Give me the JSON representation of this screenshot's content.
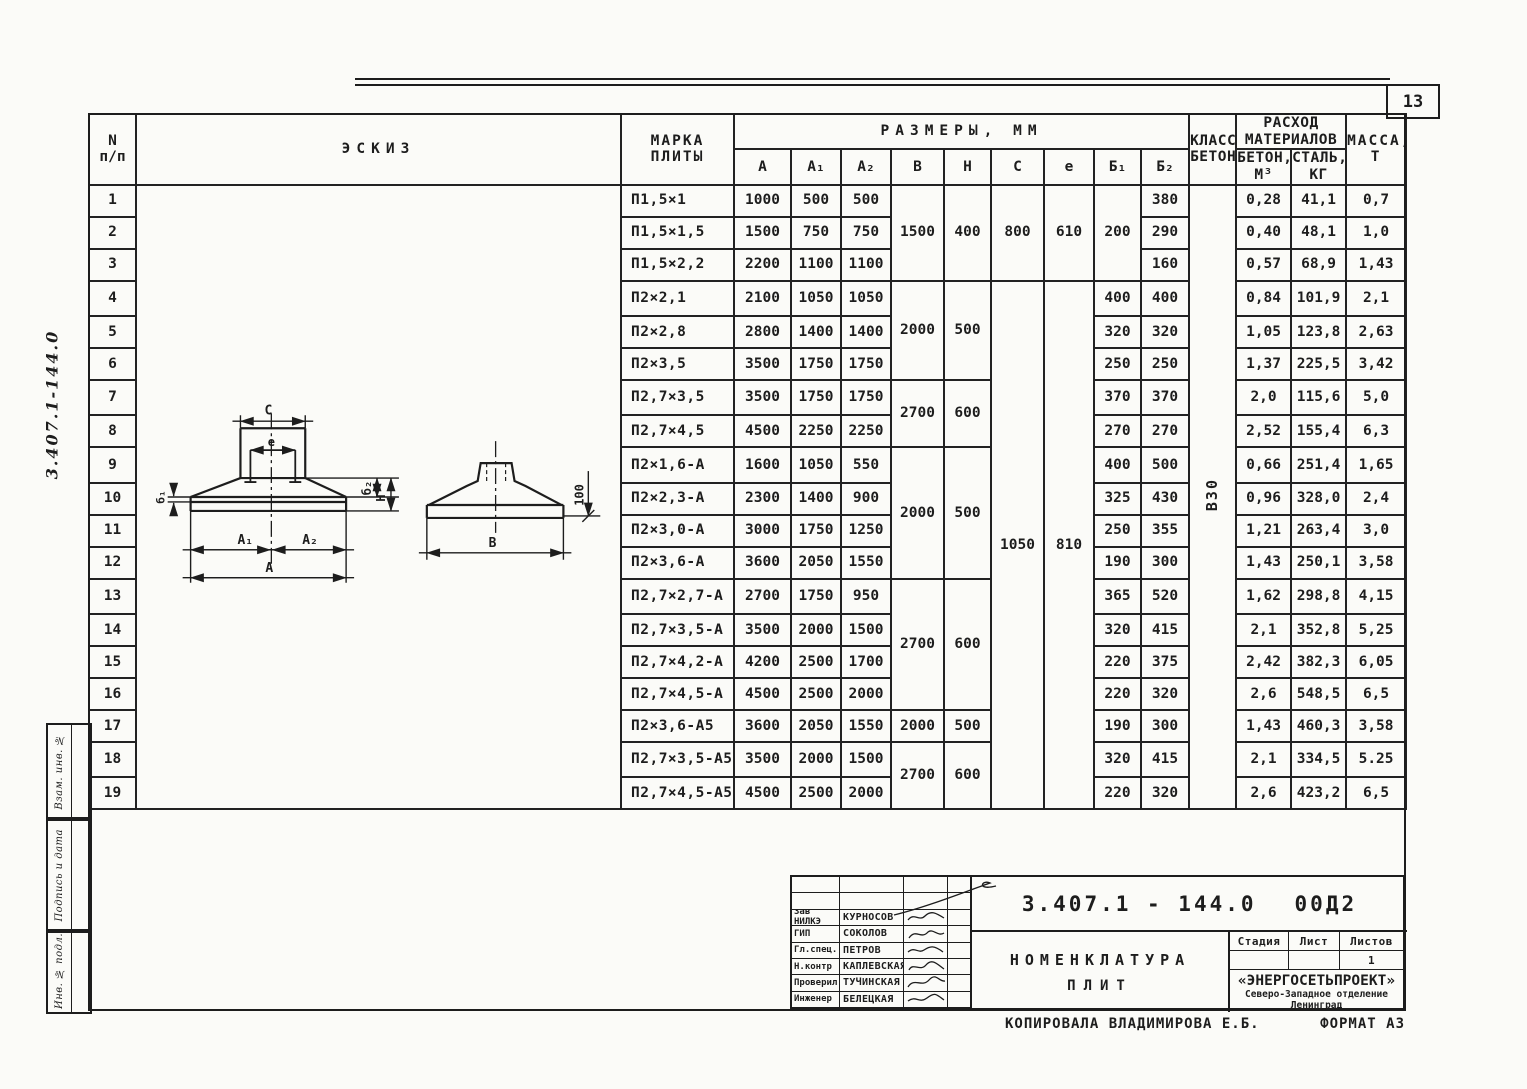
{
  "page": {
    "number": "13",
    "copied_by": "КОПИРОВАЛА ВЛАДИМИРОВА Е.Б.",
    "format": "ФОРМАТ А3"
  },
  "sidebar": {
    "doc_number_handwritten": "3.407.1-144.0",
    "boxes": [
      "Взам. инв. №",
      "Подпись и дата",
      "Инв. № подл."
    ]
  },
  "table": {
    "headers": {
      "n1": "N",
      "n2": "п/п",
      "sketch": "ЭСКИЗ",
      "mark1": "МАРКА",
      "mark2": "ПЛИТЫ",
      "dims": "РАЗМЕРЫ, ММ",
      "a": "А",
      "a1": "А₁",
      "a2": "А₂",
      "b": "В",
      "h": "Н",
      "c": "С",
      "e": "е",
      "b1": "Б₁",
      "b2": "Б₂",
      "class1": "КЛАСС",
      "class2": "БЕТОНА",
      "mat1": "РАСХОД",
      "mat2": "МАТЕРИАЛОВ",
      "concrete1": "БЕТОН,",
      "concrete2": "М³",
      "steel1": "СТАЛЬ,",
      "steel2": "КГ",
      "mass1": "МАССА,",
      "mass2": "Т"
    },
    "merged": {
      "b": [
        "1500",
        "2000",
        "2700",
        "2000",
        "2700",
        "2000",
        "2700"
      ],
      "h": [
        "400",
        "500",
        "600",
        "500",
        "600",
        "500",
        "600"
      ],
      "c": [
        "800",
        "1050"
      ],
      "e": [
        "610",
        "810"
      ],
      "b1_first": "200",
      "concrete_class": "В30"
    },
    "rows": [
      {
        "n": "1",
        "mark": "П1,5×1",
        "a": "1000",
        "a1": "500",
        "a2": "500",
        "b2": "380",
        "concrete": "0,28",
        "steel": "41,1",
        "mass": "0,7"
      },
      {
        "n": "2",
        "mark": "П1,5×1,5",
        "a": "1500",
        "a1": "750",
        "a2": "750",
        "b2": "290",
        "concrete": "0,40",
        "steel": "48,1",
        "mass": "1,0"
      },
      {
        "n": "3",
        "mark": "П1,5×2,2",
        "a": "2200",
        "a1": "1100",
        "a2": "1100",
        "b2": "160",
        "concrete": "0,57",
        "steel": "68,9",
        "mass": "1,43"
      },
      {
        "n": "4",
        "mark": "П2×2,1",
        "a": "2100",
        "a1": "1050",
        "a2": "1050",
        "b1": "400",
        "b2": "400",
        "concrete": "0,84",
        "steel": "101,9",
        "mass": "2,1"
      },
      {
        "n": "5",
        "mark": "П2×2,8",
        "a": "2800",
        "a1": "1400",
        "a2": "1400",
        "b1": "320",
        "b2": "320",
        "concrete": "1,05",
        "steel": "123,8",
        "mass": "2,63"
      },
      {
        "n": "6",
        "mark": "П2×3,5",
        "a": "3500",
        "a1": "1750",
        "a2": "1750",
        "b1": "250",
        "b2": "250",
        "concrete": "1,37",
        "steel": "225,5",
        "mass": "3,42"
      },
      {
        "n": "7",
        "mark": "П2,7×3,5",
        "a": "3500",
        "a1": "1750",
        "a2": "1750",
        "b1": "370",
        "b2": "370",
        "concrete": "2,0",
        "steel": "115,6",
        "mass": "5,0"
      },
      {
        "n": "8",
        "mark": "П2,7×4,5",
        "a": "4500",
        "a1": "2250",
        "a2": "2250",
        "b1": "270",
        "b2": "270",
        "concrete": "2,52",
        "steel": "155,4",
        "mass": "6,3"
      },
      {
        "n": "9",
        "mark": "П2×1,6-А",
        "a": "1600",
        "a1": "1050",
        "a2": "550",
        "b1": "400",
        "b2": "500",
        "concrete": "0,66",
        "steel": "251,4",
        "mass": "1,65"
      },
      {
        "n": "10",
        "mark": "П2×2,3-А",
        "a": "2300",
        "a1": "1400",
        "a2": "900",
        "b1": "325",
        "b2": "430",
        "concrete": "0,96",
        "steel": "328,0",
        "mass": "2,4"
      },
      {
        "n": "11",
        "mark": "П2×3,0-А",
        "a": "3000",
        "a1": "1750",
        "a2": "1250",
        "b1": "250",
        "b2": "355",
        "concrete": "1,21",
        "steel": "263,4",
        "mass": "3,0"
      },
      {
        "n": "12",
        "mark": "П2×3,6-А",
        "a": "3600",
        "a1": "2050",
        "a2": "1550",
        "b1": "190",
        "b2": "300",
        "concrete": "1,43",
        "steel": "250,1",
        "mass": "3,58"
      },
      {
        "n": "13",
        "mark": "П2,7×2,7-А",
        "a": "2700",
        "a1": "1750",
        "a2": "950",
        "b1": "365",
        "b2": "520",
        "concrete": "1,62",
        "steel": "298,8",
        "mass": "4,15"
      },
      {
        "n": "14",
        "mark": "П2,7×3,5-А",
        "a": "3500",
        "a1": "2000",
        "a2": "1500",
        "b1": "320",
        "b2": "415",
        "concrete": "2,1",
        "steel": "352,8",
        "mass": "5,25"
      },
      {
        "n": "15",
        "mark": "П2,7×4,2-А",
        "a": "4200",
        "a1": "2500",
        "a2": "1700",
        "b1": "220",
        "b2": "375",
        "concrete": "2,42",
        "steel": "382,3",
        "mass": "6,05"
      },
      {
        "n": "16",
        "mark": "П2,7×4,5-А",
        "a": "4500",
        "a1": "2500",
        "a2": "2000",
        "b1": "220",
        "b2": "320",
        "concrete": "2,6",
        "steel": "548,5",
        "mass": "6,5"
      },
      {
        "n": "17",
        "mark": "П2×3,6-А5",
        "a": "3600",
        "a1": "2050",
        "a2": "1550",
        "b1": "190",
        "b2": "300",
        "concrete": "1,43",
        "steel": "460,3",
        "mass": "3,58"
      },
      {
        "n": "18",
        "mark": "П2,7×3,5-А5",
        "a": "3500",
        "a1": "2000",
        "a2": "1500",
        "b1": "320",
        "b2": "415",
        "concrete": "2,1",
        "steel": "334,5",
        "mass": "5.25"
      },
      {
        "n": "19",
        "mark": "П2,7×4,5-А5",
        "a": "4500",
        "a1": "2500",
        "a2": "2000",
        "b1": "220",
        "b2": "320",
        "concrete": "2,6",
        "steel": "423,2",
        "mass": "6,5"
      }
    ]
  },
  "sketch": {
    "labels": {
      "c": "С",
      "e": "е",
      "b1": "б₁",
      "b2": "б₂",
      "h": "Н",
      "a1": "А₁",
      "a2": "А₂",
      "a": "А",
      "b": "В",
      "dim100": "100"
    }
  },
  "title_block": {
    "doc_number": "3.407.1 - 144.0",
    "doc_code": "00Д2",
    "stamp": [
      {
        "role": "Зав НИЛКЭ",
        "name": "КУРНОСОВ"
      },
      {
        "role": "ГИП",
        "name": "СОКОЛОВ"
      },
      {
        "role": "Гл.спец.",
        "name": "ПЕТРОВ"
      },
      {
        "role": "Н.контр",
        "name": "КАПЛЕВСКАЯ"
      },
      {
        "role": "Проверил",
        "name": "ТУЧИНСКАЯ"
      },
      {
        "role": "Инженер",
        "name": "БЕЛЕЦКАЯ"
      }
    ],
    "title1": "НОМЕНКЛАТУРА",
    "title2": "ПЛИТ",
    "cols": {
      "stage": "Стадия",
      "sheet": "Лист",
      "sheets": "Листов",
      "sheets_value": "1"
    },
    "org1": "«ЭНЕРГОСЕТЬПРОЕКТ»",
    "org2": "Северо-Западное отделение",
    "org3": "Ленинград"
  }
}
